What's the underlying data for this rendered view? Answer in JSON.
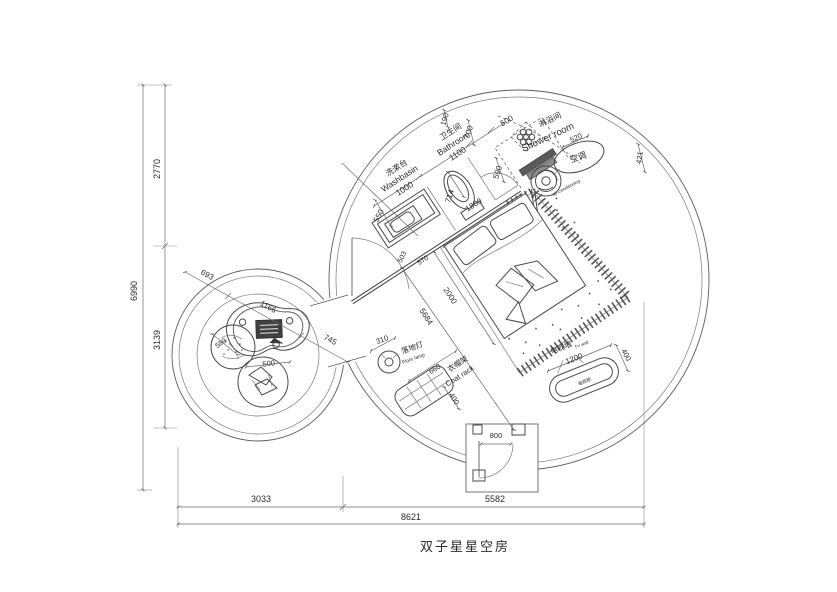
{
  "drawing": {
    "title": "双子星星空房"
  },
  "colors": {
    "line": "#4a4a4a",
    "text": "#2a2a2a",
    "background": "#ffffff",
    "dark_fill": "#4a4a4a"
  },
  "rooms": {
    "washbasin": {
      "zh": "洗漱台",
      "en": "Washbasin",
      "size": "1000"
    },
    "bathroom": {
      "zh": "卫生间",
      "en": "Bathroom",
      "size": "1100"
    },
    "shower_room": {
      "zh": "淋浴间",
      "en": "Shower room"
    },
    "air_conditioning": {
      "zh": "空调",
      "en": "air-conditioning"
    },
    "floor_lamp": {
      "zh": "落地灯",
      "en": "Floor lamp",
      "size": "310"
    },
    "coat_rack": {
      "zh": "衣帽架",
      "en": "Coat rack",
      "size": "660 x 400"
    },
    "tv_wall": {
      "zh": "电视墙",
      "en": "TV wall",
      "size": "1200 x 400"
    },
    "tv_cabinet": {
      "zh": "电视柜"
    }
  },
  "overall_dimensions": {
    "total_width": "8621",
    "total_height": "6990",
    "left_upper": "2770",
    "left_lower": "3139",
    "bottom_left": "3033",
    "bottom_right": "5582",
    "entry_door": "800",
    "bed": "1800 x 2000",
    "bed_diagonal": "5684"
  },
  "annotations": [
    {
      "name": "dim-overall-height",
      "text": "6990",
      "x": 137,
      "y": 291,
      "rot": -90,
      "fs": 9
    },
    {
      "name": "dim-upper-height",
      "text": "2770",
      "x": 160,
      "y": 169,
      "rot": -90,
      "fs": 9
    },
    {
      "name": "dim-lower-height",
      "text": "3139",
      "x": 160,
      "y": 340,
      "rot": -90,
      "fs": 9
    },
    {
      "name": "dim-bottom-left",
      "text": "3033",
      "x": 261,
      "y": 502,
      "rot": 0,
      "fs": 9
    },
    {
      "name": "dim-bottom-right",
      "text": "5582",
      "x": 495,
      "y": 502,
      "rot": 0,
      "fs": 9
    },
    {
      "name": "dim-overall-width",
      "text": "8621",
      "x": 411,
      "y": 520,
      "rot": 0,
      "fs": 9
    },
    {
      "name": "label-washbasin-zh",
      "text": "洗漱台",
      "x": 398,
      "y": 170,
      "rot": -33,
      "fs": 8
    },
    {
      "name": "label-washbasin-en",
      "text": "Washbasin",
      "x": 401,
      "y": 181,
      "rot": -33,
      "fs": 8.5
    },
    {
      "name": "dim-washbasin-1000",
      "text": "1000",
      "x": 406,
      "y": 191,
      "rot": -33,
      "fs": 8.5
    },
    {
      "name": "label-bathroom-zh",
      "text": "卫生间",
      "x": 452,
      "y": 134,
      "rot": -33,
      "fs": 8
    },
    {
      "name": "label-bathroom-en",
      "text": "Bathroom",
      "x": 455,
      "y": 146,
      "rot": -33,
      "fs": 8.5
    },
    {
      "name": "dim-bathroom-1100",
      "text": "1100",
      "x": 459,
      "y": 156,
      "rot": -33,
      "fs": 8.5
    },
    {
      "name": "label-shower-zh",
      "text": "淋浴间",
      "x": 551,
      "y": 122,
      "rot": -25,
      "fs": 8
    },
    {
      "name": "label-shower-en",
      "text": "Shower room",
      "x": 549,
      "y": 140,
      "rot": -25,
      "fs": 9.5
    },
    {
      "name": "label-ac-zh",
      "text": "空调",
      "x": 579,
      "y": 160,
      "rot": -20,
      "fs": 8.5
    },
    {
      "name": "label-ac-en",
      "text": "air-conditioning",
      "x": 567,
      "y": 189,
      "rot": -28,
      "fs": 4.5
    },
    {
      "name": "dim-190",
      "text": "190",
      "x": 447,
      "y": 120,
      "rot": -72,
      "fs": 7.5
    },
    {
      "name": "dim-700",
      "text": "700",
      "x": 471,
      "y": 133,
      "rot": -72,
      "fs": 8
    },
    {
      "name": "dim-500-shower-door",
      "text": "500",
      "x": 508,
      "y": 123,
      "rot": -30,
      "fs": 8
    },
    {
      "name": "dim-590",
      "text": "590",
      "x": 500,
      "y": 173,
      "rot": -72,
      "fs": 8
    },
    {
      "name": "dim-714",
      "text": "714",
      "x": 452,
      "y": 197,
      "rot": -72,
      "fs": 8
    },
    {
      "name": "dim-1800",
      "text": "1800",
      "x": 475,
      "y": 207,
      "rot": -33,
      "fs": 8
    },
    {
      "name": "dim-550",
      "text": "550",
      "x": 381,
      "y": 217,
      "rot": -62,
      "fs": 8
    },
    {
      "name": "dim-503",
      "text": "503",
      "x": 404,
      "y": 258,
      "rot": -62,
      "fs": 7
    },
    {
      "name": "dim-570",
      "text": "570",
      "x": 424,
      "y": 262,
      "rot": -33,
      "fs": 7
    },
    {
      "name": "dim-2000",
      "text": "2000",
      "x": 448,
      "y": 297,
      "rot": 57,
      "fs": 8
    },
    {
      "name": "dim-5684",
      "text": "5684",
      "x": 424,
      "y": 318,
      "rot": 57,
      "fs": 8
    },
    {
      "name": "dim-520",
      "text": "520",
      "x": 577,
      "y": 140,
      "rot": -25,
      "fs": 7.5
    },
    {
      "name": "dim-421",
      "text": "421",
      "x": 642,
      "y": 158,
      "rot": -82,
      "fs": 7.5
    },
    {
      "name": "dim-693",
      "text": "693",
      "x": 206,
      "y": 277,
      "rot": 29,
      "fs": 8
    },
    {
      "name": "dim-1166",
      "text": "1166",
      "x": 267,
      "y": 309,
      "rot": 29,
      "fs": 8
    },
    {
      "name": "dim-745",
      "text": "745",
      "x": 329,
      "y": 342,
      "rot": 29,
      "fs": 8
    },
    {
      "name": "dim-310",
      "text": "310",
      "x": 383,
      "y": 342,
      "rot": -20,
      "fs": 7.5
    },
    {
      "name": "label-lamp-zh",
      "text": "落地灯",
      "x": 413,
      "y": 350,
      "rot": -20,
      "fs": 7.5
    },
    {
      "name": "label-lamp-en",
      "text": "Floor lamp",
      "x": 414,
      "y": 360,
      "rot": -20,
      "fs": 5
    },
    {
      "name": "dim-660",
      "text": "660",
      "x": 436,
      "y": 371,
      "rot": -33,
      "fs": 7.5
    },
    {
      "name": "label-rack-zh",
      "text": "衣帽架",
      "x": 459,
      "y": 366,
      "rot": -33,
      "fs": 7.5
    },
    {
      "name": "label-rack-en",
      "text": "Coat rack",
      "x": 461,
      "y": 378,
      "rot": -33,
      "fs": 7.5
    },
    {
      "name": "dim-rack-400",
      "text": "400",
      "x": 452,
      "y": 400,
      "rot": 57,
      "fs": 7.5
    },
    {
      "name": "label-tv-zh",
      "text": "电视墙",
      "x": 562,
      "y": 350,
      "rot": -22,
      "fs": 7.5
    },
    {
      "name": "label-tv-en",
      "text": "TV wall",
      "x": 582,
      "y": 346,
      "rot": -22,
      "fs": 4.5
    },
    {
      "name": "dim-1200",
      "text": "1200",
      "x": 575,
      "y": 361,
      "rot": -22,
      "fs": 8
    },
    {
      "name": "dim-tv-400",
      "text": "400",
      "x": 624,
      "y": 356,
      "rot": 62,
      "fs": 7.5
    },
    {
      "name": "label-tv-cabinet",
      "text": "电视柜",
      "x": 585,
      "y": 383,
      "rot": -22,
      "fs": 4.5
    },
    {
      "name": "dim-800",
      "text": "800",
      "x": 496,
      "y": 438,
      "rot": 0,
      "fs": 7.5
    },
    {
      "name": "dim-589",
      "text": "589",
      "x": 222,
      "y": 345,
      "rot": -35,
      "fs": 7
    },
    {
      "name": "dim-500-chair",
      "text": "500",
      "x": 269,
      "y": 366,
      "rot": -8,
      "fs": 7.5
    }
  ]
}
